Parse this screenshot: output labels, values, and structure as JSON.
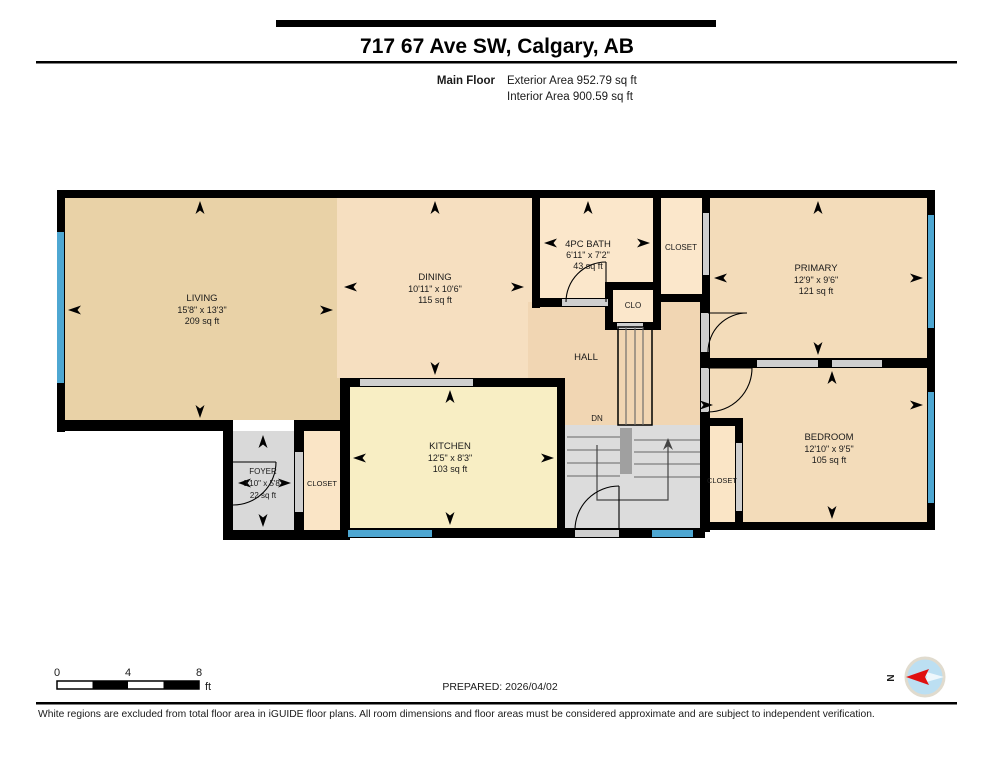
{
  "header": {
    "title": "717 67 Ave SW, Calgary, AB",
    "floor_label": "Main Floor",
    "exterior_area": "Exterior Area 952.79 sq ft",
    "interior_area": "Interior Area 900.59 sq ft"
  },
  "rooms": {
    "living": {
      "name": "LIVING",
      "dims": "15'8\" x 13'3\"",
      "area": "209 sq ft"
    },
    "dining": {
      "name": "DINING",
      "dims": "10'11\" x 10'6\"",
      "area": "115 sq ft"
    },
    "bath": {
      "name": "4PC BATH",
      "dims": "6'11\" x 7'2\"",
      "area": "43 sq ft"
    },
    "primary": {
      "name": "PRIMARY",
      "dims": "12'9\" x 9'6\"",
      "area": "121 sq ft"
    },
    "bedroom": {
      "name": "BEDROOM",
      "dims": "12'10\" x 9'5\"",
      "area": "105 sq ft"
    },
    "kitchen": {
      "name": "KITCHEN",
      "dims": "12'5\" x 8'3\"",
      "area": "103 sq ft"
    },
    "foyer": {
      "name": "FOYER",
      "dims": "3'10\" x 5'8\"",
      "area": "22 sq ft"
    },
    "hall": {
      "name": "HALL"
    },
    "closet_top": {
      "name": "CLOSET"
    },
    "closet_foyer": {
      "name": "CLOSET"
    },
    "closet_bedroom": {
      "name": "CLOSET"
    },
    "clo": {
      "name": "CLO"
    },
    "stairs_down_label": "DN"
  },
  "footer": {
    "prepared": "PREPARED: 2026/04/02",
    "scale": {
      "t0": "0",
      "t4": "4",
      "t8": "8",
      "unit": "ft"
    },
    "compass_north": "N",
    "disclaimer": "White regions are excluded from total floor area in iGUIDE floor plans. All room dimensions and floor areas must be considered approximate and are subject to independent verification."
  },
  "colors": {
    "wall": "#000000",
    "window_blue": "#4ea7d2",
    "door_opening_grey": "#cfcfcf",
    "living_fill": "#e9d2a7",
    "dining_fill": "#f6dfc0",
    "hall_fill": "#f1d6b3",
    "bedroom_fill": "#f3dcba",
    "bath_closet_fill": "#fbe7cb",
    "kitchen_fill": "#f8eec4",
    "excluded_grey": "#d9d9d9",
    "compass_fill": "#bcdff2",
    "compass_needle": "#e01010"
  }
}
